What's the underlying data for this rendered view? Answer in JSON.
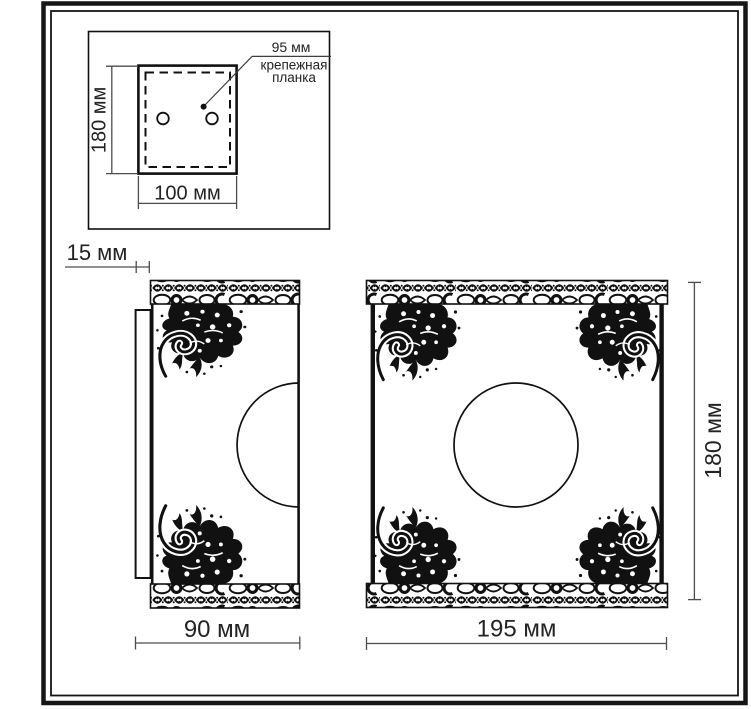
{
  "inset": {
    "height_label": "180 мм",
    "width_label": "100 мм",
    "pitch_label": "95 мм",
    "note_line1": "крепежная",
    "note_line2": "планка"
  },
  "side_view": {
    "plate_depth_label": "15 мм",
    "depth_label": "90 мм"
  },
  "front_view": {
    "width_label": "195 мм",
    "height_label": "180 мм"
  },
  "colors": {
    "line": "#111111",
    "dimension": "#4d4d4d",
    "text": "#232323",
    "background": "#ffffff"
  }
}
